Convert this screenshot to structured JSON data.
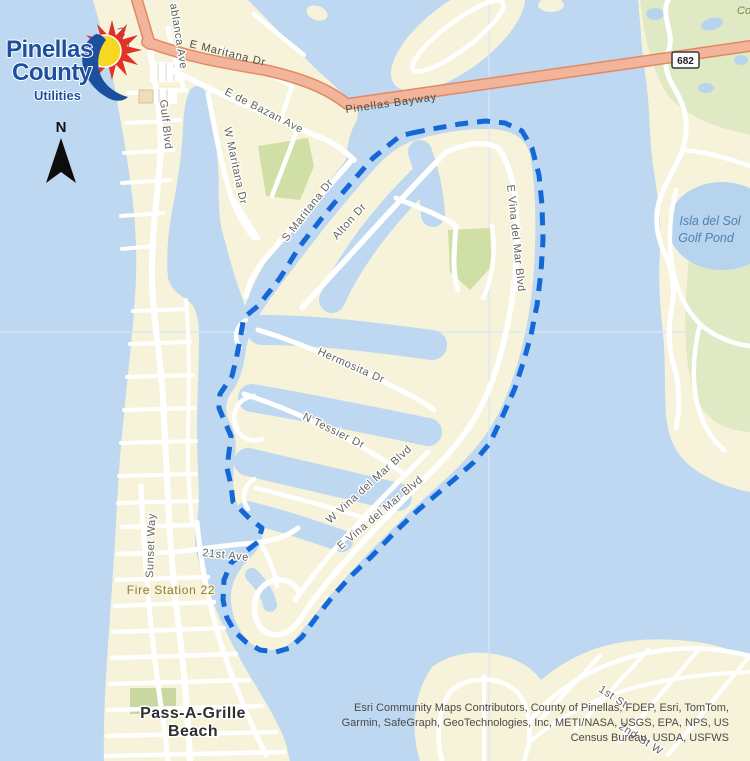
{
  "map": {
    "logo": {
      "line1": "Pinellas",
      "line2": "County",
      "line3": "Utilities"
    },
    "north_label": "N",
    "route_shield": "682",
    "streets": {
      "ro_st": "ro St",
      "casablanca": "ablanca Ave",
      "e_maritana": "E Maritana Dr",
      "pinellas_bayway": "Pinellas Bayway",
      "e_de_bazan": "E de Bazan Ave",
      "w_maritana": "W Maritana Dr",
      "s_maritana": "S Maritana Dr",
      "gulf_blvd": "Gulf Blvd",
      "alton": "Alton Dr",
      "e_vina_n": "E Vina del Mar Blvd",
      "hermosita": "Hermosita Dr",
      "n_tessier": "N Tessier Dr",
      "w_vina": "W Vina del Mar Blvd",
      "e_vina_s": "E Vina del Mar Blvd",
      "ave21": "21st Ave",
      "sunset_way": "Sunset Way",
      "first_st": "1st St",
      "second_st_w": "2nd St W"
    },
    "places": {
      "fire_station": "Fire Station 22",
      "pass_a_grille_1": "Pass-A-Grille",
      "pass_a_grille_2": "Beach",
      "golf_pond_1": "Isla del Sol",
      "golf_pond_2": "Golf Pond",
      "corner_fragment": "Co"
    },
    "attribution": {
      "l1": "Esri Community Maps Contributors, County of Pinellas, FDEP, Esri, TomTom,",
      "l2": "Garmin, SafeGraph, GeoTechnologies, Inc, METI/NASA, USGS, EPA, NPS, US",
      "l3": "Census Bureau, USDA, USFWS"
    },
    "colors": {
      "water": "#bdd8f0",
      "land": "#f6f3da",
      "park_green": "#cfdfa6",
      "golf_green": "#dfe9c3",
      "major_road_fill": "#f2b59b",
      "major_road_casing": "#e18a60",
      "boundary_blue": "#1467d6",
      "logo_blue": "#1d4f9f",
      "sun_yellow": "#f7d820",
      "burst_red": "#e23126"
    }
  }
}
